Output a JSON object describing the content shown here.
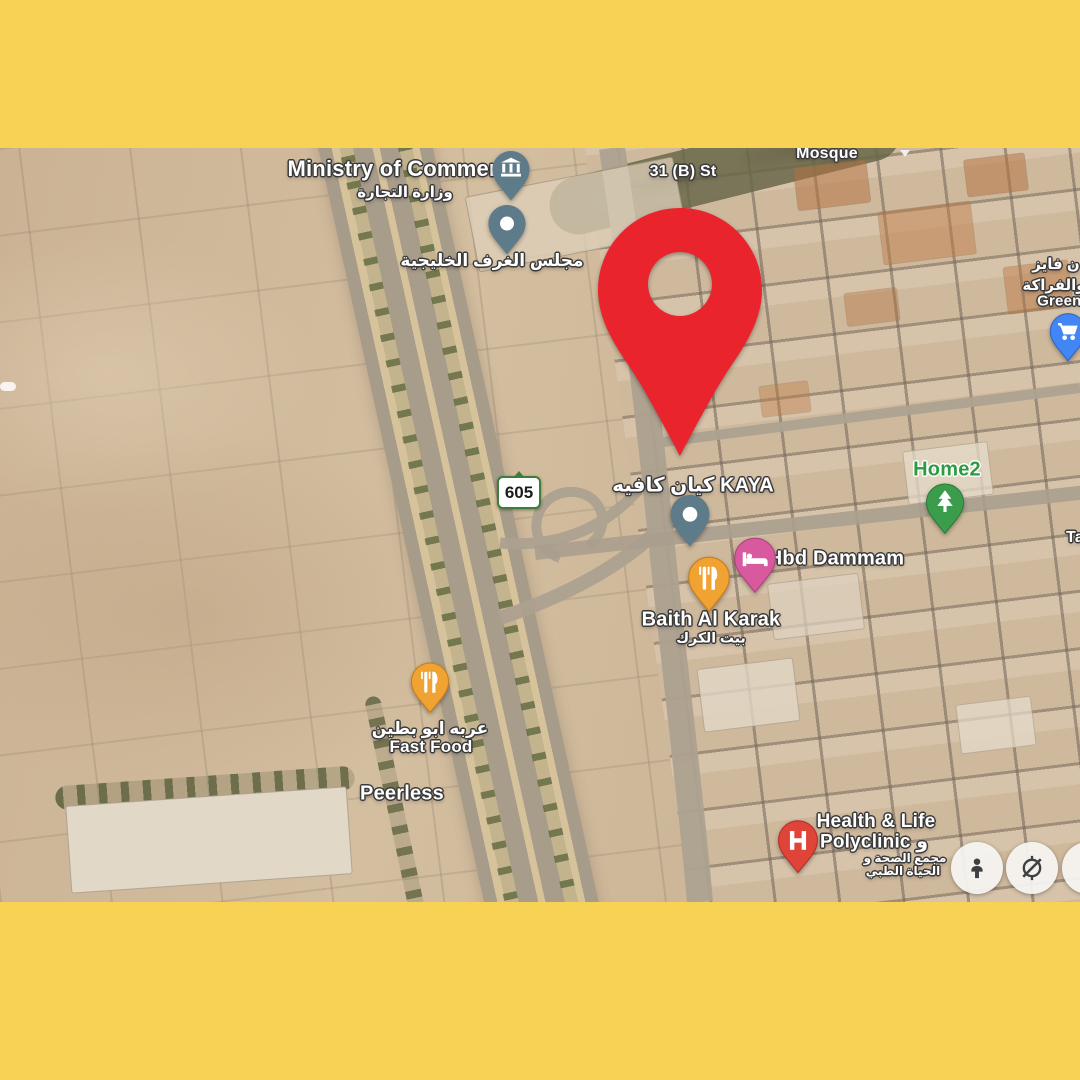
{
  "app": {
    "type": "satellite-map-poster"
  },
  "frame": {
    "color": "#F8D254"
  },
  "colors": {
    "marker_red": "#E9242C",
    "poi_slate": "#5E7B8A",
    "hotel_pink": "#D9599F",
    "food_orange": "#F0A232",
    "home_green": "#3B9C4B",
    "store_blue": "#4285F4",
    "health_red": "#E04438",
    "route_shield_green": "#3E7D3A",
    "desert_tan": "#CDB497"
  },
  "map": {
    "streets": {
      "s31b": "31 (B) St",
      "route605": "605",
      "ta_partial": "Ta"
    },
    "places": {
      "ministry": {
        "en": "Ministry of Commerce",
        "ar": "وزارة التجارة"
      },
      "gulf_chambers": {
        "ar": "مجلس الغرف الخليجية"
      },
      "mosque": {
        "en": "Mosque"
      },
      "kaya": {
        "label": "كيان كافيه KAYA"
      },
      "hbd": {
        "en": "Hbd Dammam"
      },
      "baith": {
        "en": "Baith Al Karak",
        "ar": "بيت الكرك"
      },
      "home2": {
        "en": "Home2"
      },
      "greengrocery": {
        "ar1": "ن فايز",
        "ar2": "والفراكة",
        "en": "Greeng"
      },
      "fastfood": {
        "ar": "عربه ابو بطين",
        "en": "Fast Food"
      },
      "peerless": {
        "en": "Peerless"
      },
      "health": {
        "en1": "Health & Life",
        "en2": "Polyclinic و",
        "ar1": "مجمع الصحة و",
        "ar2": "الحياة الطبي"
      }
    },
    "controls": {
      "partial": "2"
    }
  }
}
